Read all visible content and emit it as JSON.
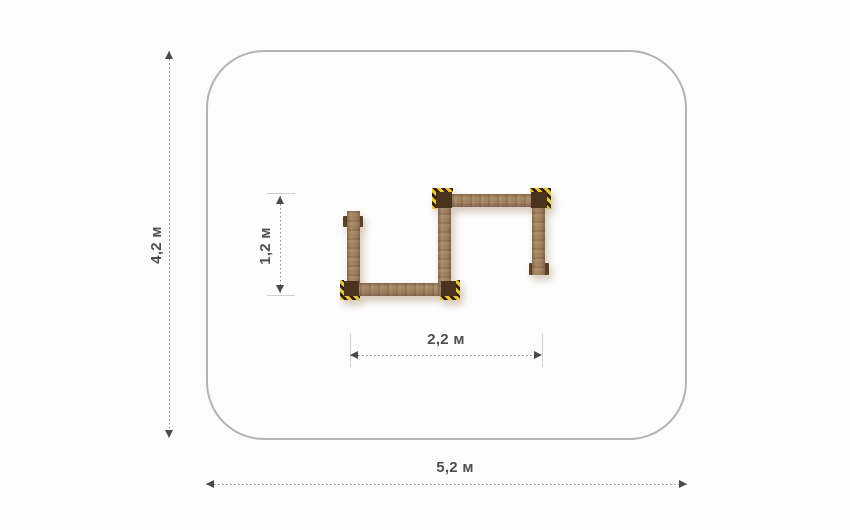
{
  "dims": {
    "outer_width": "5,2 м",
    "outer_height": "4,2 м",
    "inner_width": "2,2 м",
    "inner_height": "1,2 м"
  },
  "colors": {
    "background": "#fcfcfc",
    "outline": "#b3b3b3",
    "dim_line": "#8d8d8d",
    "dim_tick": "#cfcfcf",
    "dim_arrow": "#4a4a4a",
    "dim_text": "#4f4f4f",
    "wood_base": "#9c7d5d",
    "wood_dark": "#87684a",
    "wood_light": "#a98a66",
    "cap_brown": "#4b341d",
    "hazard_yellow": "#e9c73d",
    "tab_brown": "#5a4024"
  }
}
